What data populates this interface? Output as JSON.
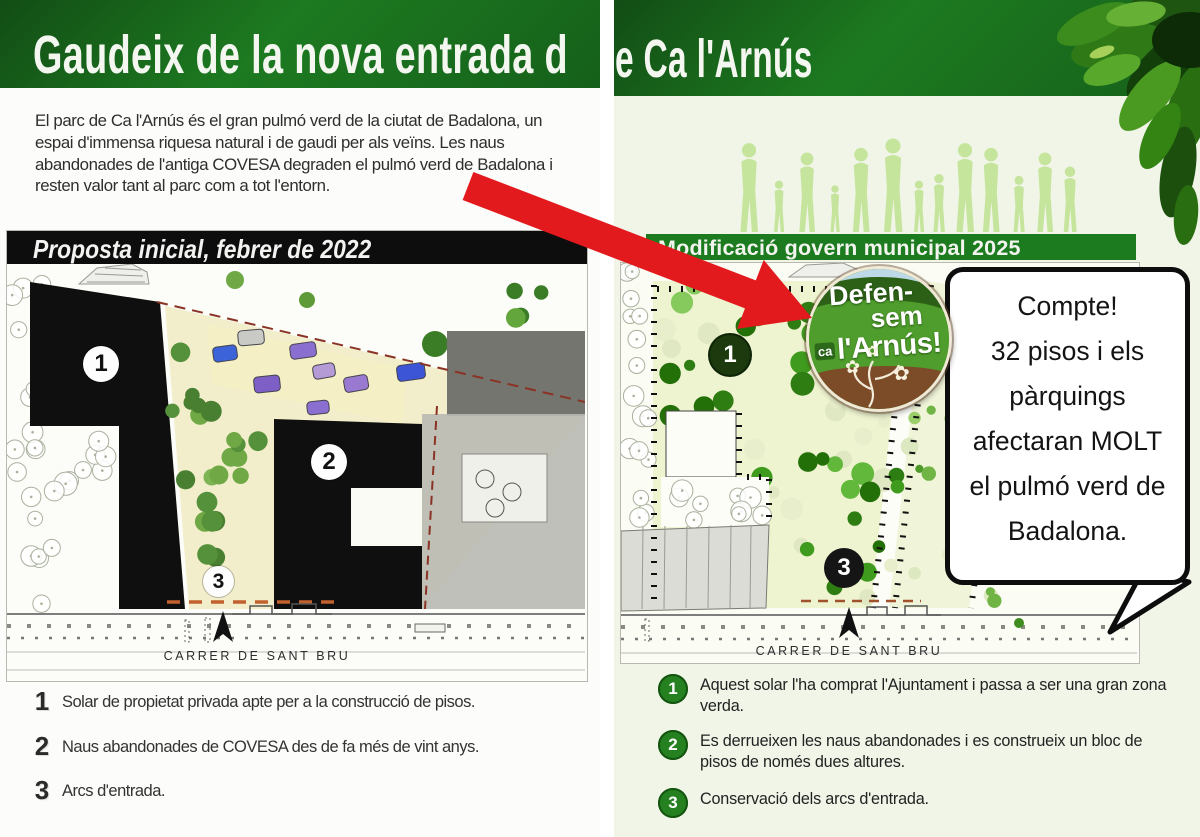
{
  "left_panel": {
    "title_fragment": "Gaudeix de la nova entrada d",
    "intro_text": "El parc de Ca l'Arnús és el gran pulmó verd de la ciutat de Badalona, un espai d'immensa riquesa natural i de gaudi per als veïns. Les naus abandonades de l'antiga COVESA degraden el pulmó verd de Badalona i resten valor tant al parc com a tot l'entorn.",
    "map_banner": "Proposta inicial, febrer de 2022",
    "street_label": "CARRER DE SANT BRU",
    "markers": {
      "m1": "1",
      "m2": "2",
      "m3": "3"
    },
    "legend": [
      {
        "num": "1",
        "text": "Solar de propietat privada apte per a la construcció de pisos."
      },
      {
        "num": "2",
        "text": "Naus abandonades de COVESA des de fa més de vint anys."
      },
      {
        "num": "3",
        "text": "Arcs d'entrada."
      }
    ]
  },
  "right_panel": {
    "title_fragment": "e Ca l'Arnús",
    "map_banner": "Modificació govern municipal 2025",
    "street_label": "CARRER DE SANT BRU",
    "markers": {
      "m1": "1",
      "m3": "3"
    },
    "badge": {
      "word1": "Defen-",
      "word2": "sem",
      "prefix": "ca",
      "word3": "l'Arnús!",
      "flower_icon": "✿"
    },
    "bubble_lines": [
      "Compte!",
      "32 pisos i els",
      "pàrquings",
      "afectaran MOLT",
      "el pulmó verd de",
      "Badalona."
    ],
    "legend": [
      {
        "num": "1",
        "text": "Aquest solar l'ha comprat l'Ajuntament i passa a ser una gran zona verda."
      },
      {
        "num": "2",
        "text": "Es derrueixen les naus abandonades i es construeix un bloc de pisos de només dues altures."
      },
      {
        "num": "3",
        "text": "Conservació dels arcs d'entrada."
      }
    ]
  },
  "colors": {
    "header_green": "#1d7a20",
    "banner_black": "#0d0d0d",
    "legend_green": "#25801f",
    "annotation_red": "#e21a1d",
    "badge_green": "#4f9d2c",
    "badge_brown": "#7c4c29",
    "silhouette_green": "#c5e49c"
  }
}
